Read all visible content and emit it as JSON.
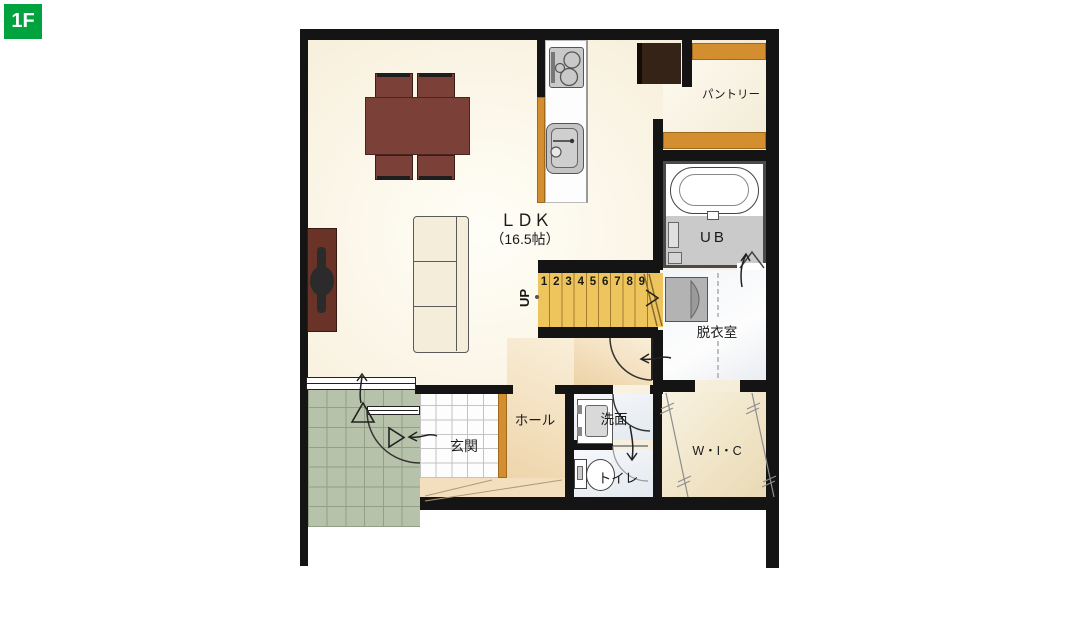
{
  "badge": {
    "label": "1F"
  },
  "rooms": {
    "ldk": {
      "name": "ＬＤＫ",
      "size": "（16.5帖）"
    },
    "pantry": {
      "name": "パントリー"
    },
    "unit_bath": {
      "name": "UB"
    },
    "dressing_room": {
      "name": "脱衣室"
    },
    "hall": {
      "name": "ホール"
    },
    "entrance": {
      "name": "玄関"
    },
    "washroom": {
      "name": "洗面"
    },
    "toilet": {
      "name": "トイレ"
    },
    "walk_in_closet": {
      "name": "W・I・C"
    }
  },
  "stairs": {
    "direction_label": "UP",
    "steps": [
      "1",
      "2",
      "3",
      "4",
      "5",
      "6",
      "7",
      "8",
      "9"
    ]
  },
  "colors": {
    "badge_green": "#00a33e",
    "wall_black": "#141414",
    "stair_yellow": "#eec45c",
    "wood_orange": "#d28e2f",
    "porch_green": "#b7c2aa",
    "table_maroon": "#7b4038",
    "tv_board_brown": "#6a3328",
    "fridge_brown": "#362318"
  }
}
